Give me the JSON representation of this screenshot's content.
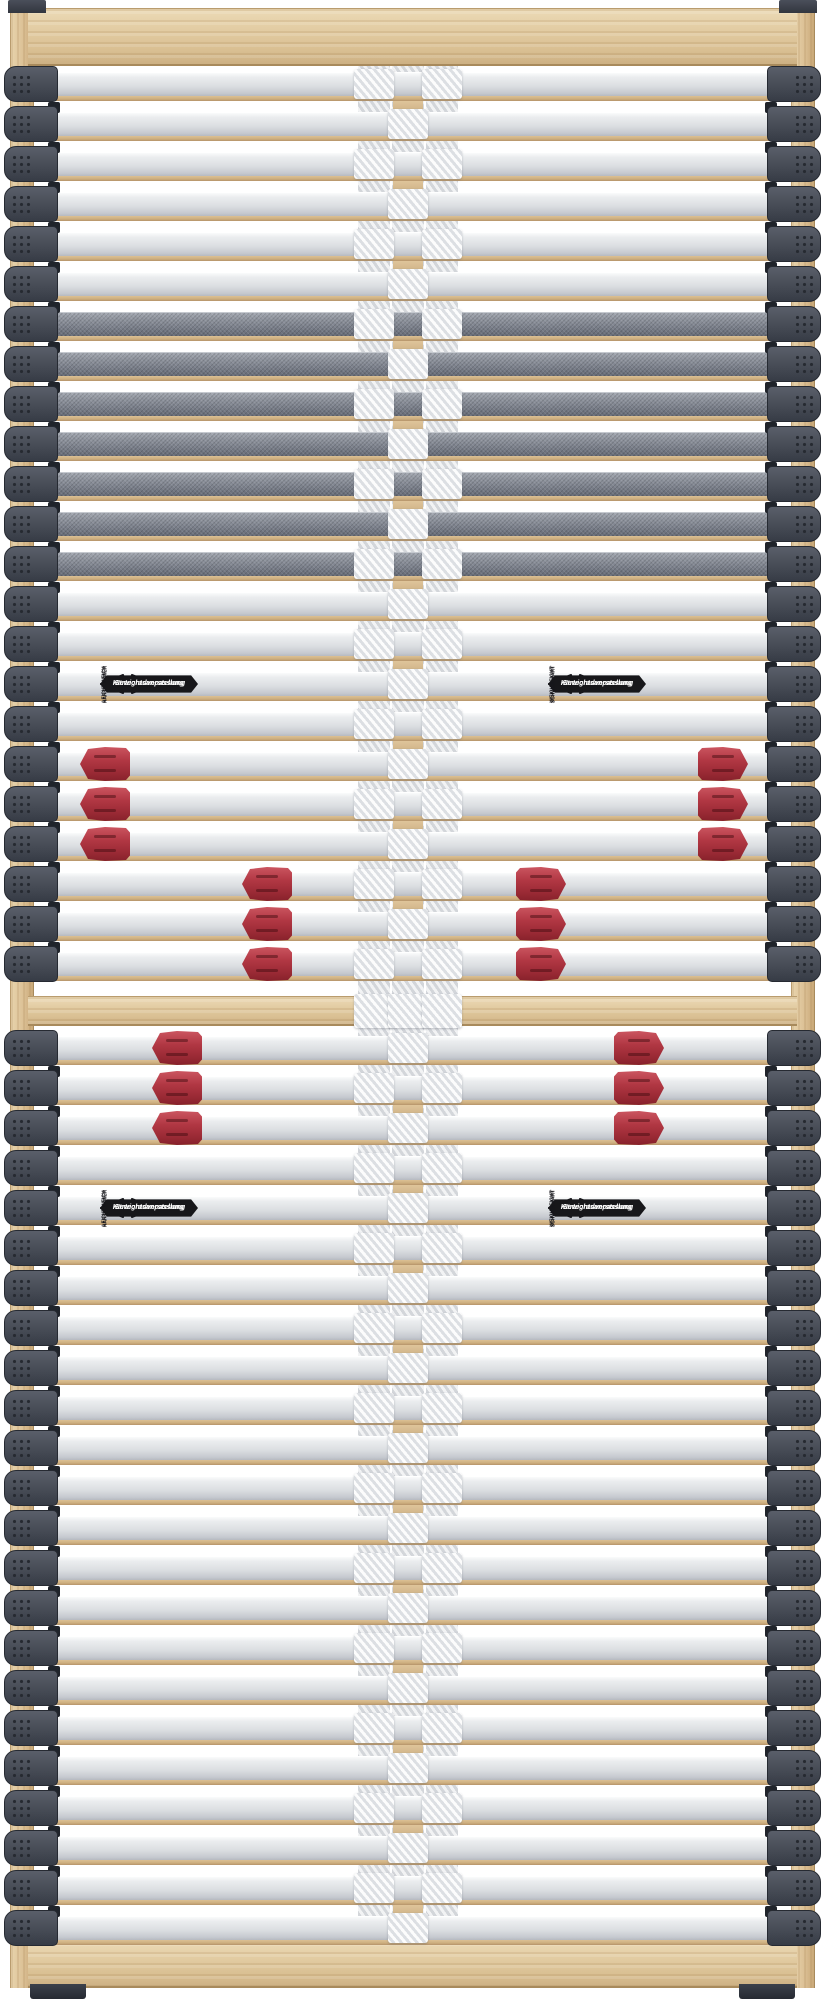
{
  "scene": {
    "description": "Top-down product photo of a two-section 7-zone slatted bed base (Lattenrost) with adjustable firmness sliders",
    "background_color": "#ffffff",
    "wood_color": "#ddc69e",
    "slat_color": "#dde0e3",
    "dark_slat_color": "#767b86",
    "end_cap_color": "#474c57",
    "slider_color": "#ae3440",
    "strap_color": "#e4e6e8",
    "structure": {
      "upper_row_count": 23,
      "lower_row_count": 23,
      "dark_rows_upper": [
        6,
        7,
        8,
        9,
        10,
        11,
        12
      ],
      "label_row_upper": 15,
      "label_row_lower": 4,
      "vertical_straps": 3
    },
    "sliders": [
      {
        "half": "upper",
        "rows": [
          17,
          18,
          19
        ],
        "x": 80,
        "dir": "left"
      },
      {
        "half": "upper",
        "rows": [
          17,
          18,
          19
        ],
        "x": 698,
        "dir": "right"
      },
      {
        "half": "upper",
        "rows": [
          20,
          21,
          22
        ],
        "x": 242,
        "dir": "left"
      },
      {
        "half": "upper",
        "rows": [
          20,
          21,
          22
        ],
        "x": 516,
        "dir": "right"
      },
      {
        "half": "lower",
        "rows": [
          0,
          1,
          2
        ],
        "x": 152,
        "dir": "left"
      },
      {
        "half": "lower",
        "rows": [
          0,
          1,
          2
        ],
        "x": 614,
        "dir": "right"
      }
    ]
  },
  "labels": {
    "badge_line1": "Härtegradverstellung",
    "badge_line2": "Gewichtsanpassung",
    "instances": [
      {
        "half": "upper",
        "x": 100,
        "left_caption": "HART SCHWER",
        "right_caption": "LEICHT WEICH"
      },
      {
        "half": "upper",
        "x": 548,
        "left_caption": "WEICH LEICHT",
        "right_caption": "SCHWER HART"
      },
      {
        "half": "lower",
        "x": 100,
        "left_caption": "HART SCHWER",
        "right_caption": "LEICHT WEICH"
      },
      {
        "half": "lower",
        "x": 548,
        "left_caption": "WEICH LEICHT",
        "right_caption": "SCHWER HART"
      }
    ]
  }
}
